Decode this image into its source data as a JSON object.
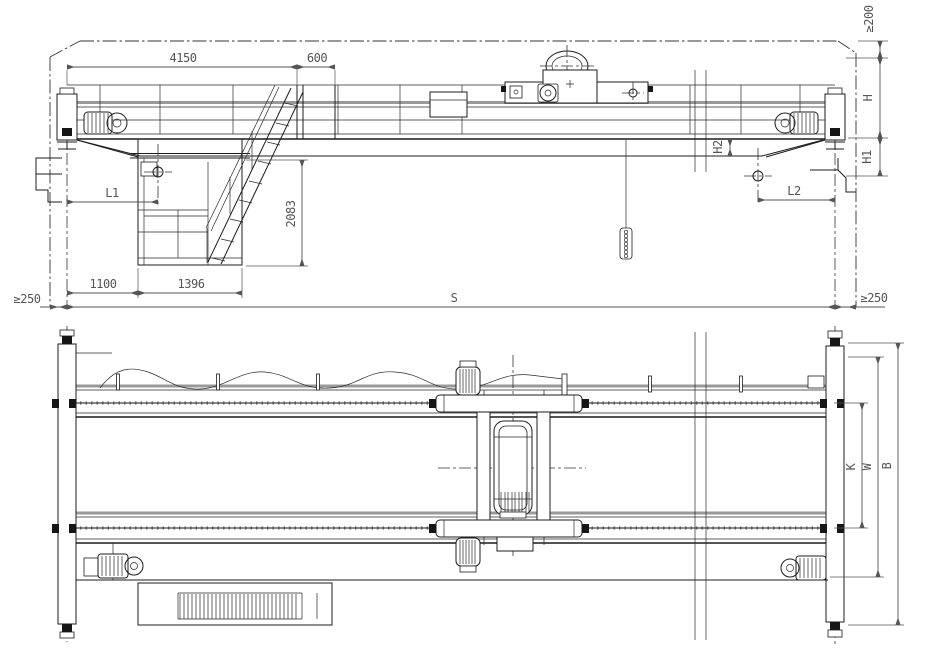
{
  "front_view": {
    "dims": {
      "span_top": "4150",
      "stair_width": "600",
      "top_clearance": "≥200",
      "height_h": "H",
      "height_h1": "H1",
      "height_h2": "H2",
      "hook_left_approach": "L1",
      "hook_right_approach": "L2",
      "cab_height": "2083",
      "cab_offset": "1100",
      "cab_width": "1396",
      "span": "S",
      "left_clearance": "≥250",
      "right_clearance": "≥250"
    }
  },
  "plan_view": {
    "dims": {
      "rail_gauge_k": "K",
      "trolley_width_w": "W",
      "wheel_base_b": "B"
    }
  },
  "style": {
    "ink": "#1c1c1c",
    "dim_ink": "#555555",
    "rail_gray": "#999999",
    "background": "#ffffff"
  }
}
